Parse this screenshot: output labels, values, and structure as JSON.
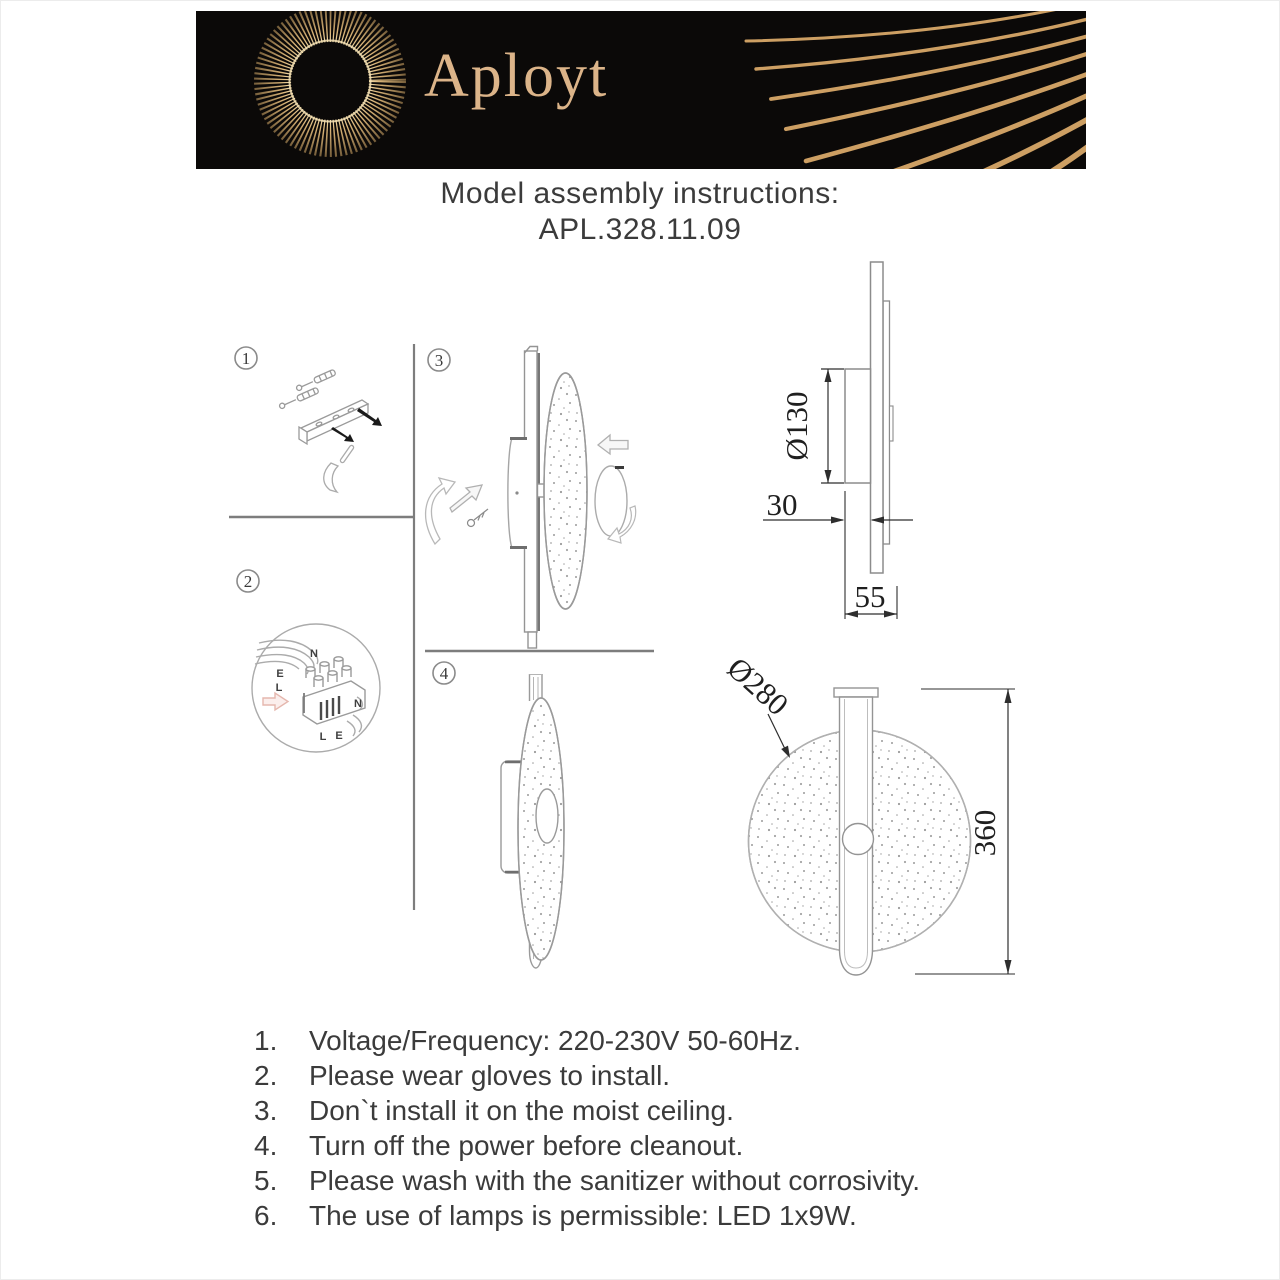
{
  "header": {
    "brand": "Aployt"
  },
  "title": {
    "heading": "Model assembly instructions:",
    "model": "APL.328.11.09"
  },
  "steps": [
    "1",
    "2",
    "3",
    "4"
  ],
  "wiring": {
    "n_in": "N",
    "e_in": "E",
    "l_in": "L",
    "n_out": "N",
    "l_out": "L",
    "e_out": "E"
  },
  "dimensions": {
    "canopy_diameter": "Ø130",
    "canopy_depth": "30",
    "total_depth": "55",
    "disc_diameter": "Ø280",
    "total_height": "360"
  },
  "notes": [
    {
      "num": "1.",
      "text": "Voltage/Frequency: 220-230V 50-60Hz."
    },
    {
      "num": "2.",
      "text": "Please wear gloves to install."
    },
    {
      "num": "3.",
      "text": "Don`t install it on the moist ceiling."
    },
    {
      "num": "4.",
      "text": "Turn off the power before cleanout."
    },
    {
      "num": "5.",
      "text": "Please wash with the sanitizer without corrosivity."
    },
    {
      "num": "6.",
      "text": "The use of lamps is permissible: LED 1x9W."
    }
  ],
  "colors": {
    "header_bg": "#0b0908",
    "accent_gold": "#cfa265",
    "brand_text": "#dcb489",
    "drawing_line": "#9a9a9a",
    "dimension_ink": "#222222",
    "body_text": "#3b3b3b"
  }
}
